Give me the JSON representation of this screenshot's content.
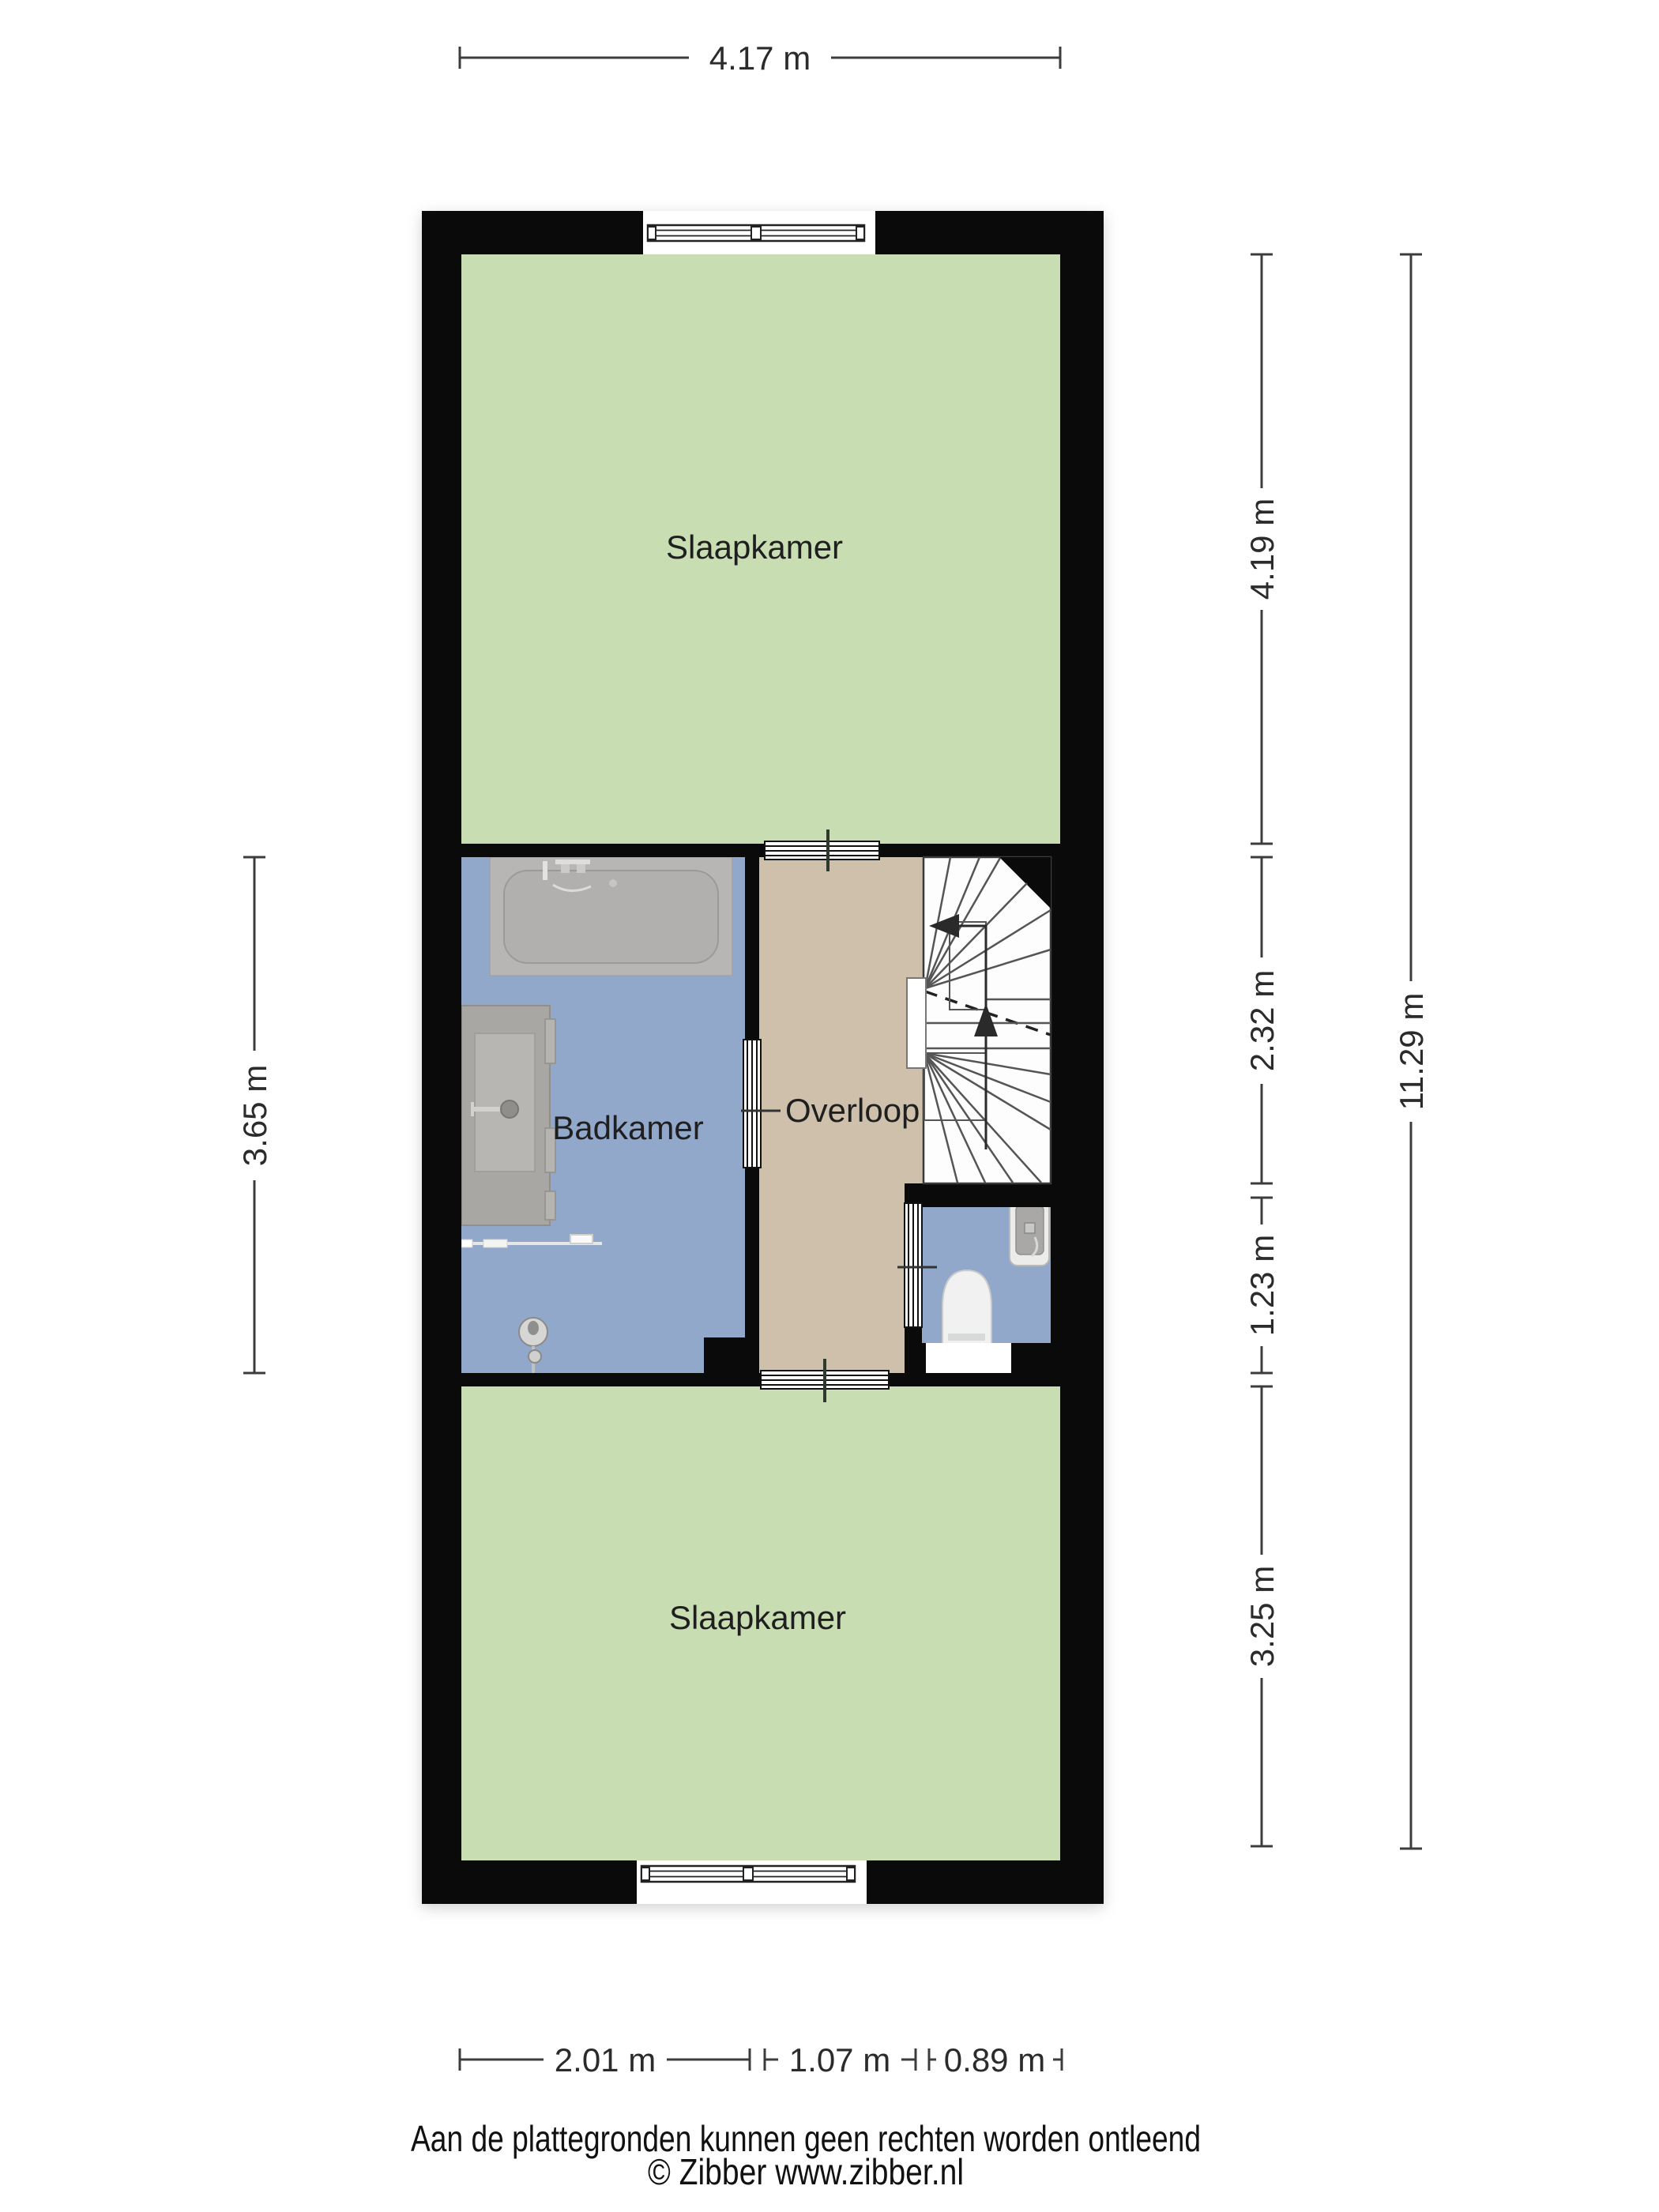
{
  "plan": {
    "type": "floorplan-first-floor",
    "rooms": {
      "bedroom_top": "Slaapkamer",
      "bathroom": "Badkamer",
      "landing": "Overloop",
      "bedroom_bottom": "Slaapkamer"
    },
    "fixtures": [
      "bathtub",
      "vanity-sink",
      "towel-rail",
      "shower-head",
      "staircase",
      "toilet",
      "wc-sink"
    ]
  },
  "dimensions": {
    "top_width": "4.17 m",
    "right_top": "4.19 m",
    "right_middle": "2.32 m",
    "right_lower": "1.23 m",
    "right_bottom": "3.25 m",
    "right_total": "11.29 m",
    "left_middle": "3.65 m",
    "bottom_left": "2.01 m",
    "bottom_middle": "1.07 m",
    "bottom_right": "0.89 m"
  },
  "footer": {
    "disclaimer": "Aan de plattegronden kunnen geen rechten worden ontleend",
    "copyright": "© Zibber www.zibber.nl"
  },
  "colors": {
    "bedroom": "#c9ddb2",
    "bathroom": "#92a8cb",
    "landing": "#cec0ab",
    "wall": "#0a0a0a",
    "stair_floor": "#fdfdfd",
    "fixture_gray": "#b3b2b0",
    "background": "#ffffff"
  }
}
